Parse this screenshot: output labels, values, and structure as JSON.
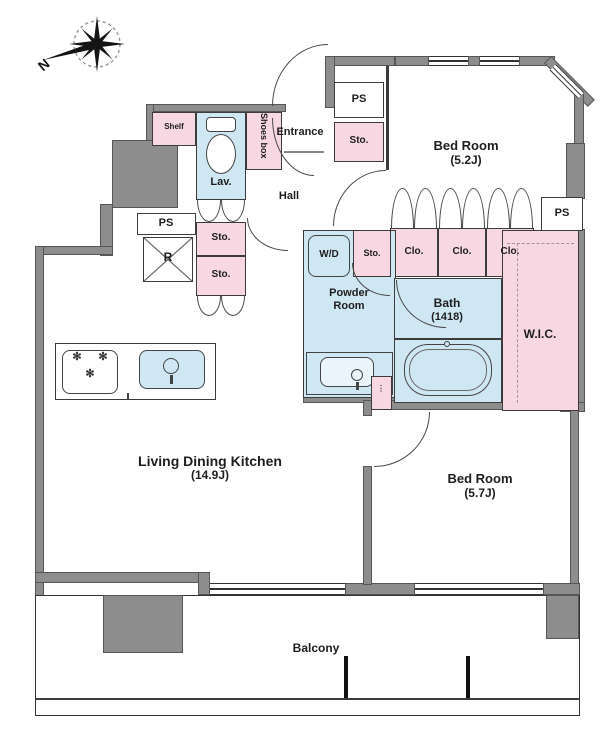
{
  "compass": {
    "north": "N"
  },
  "colors": {
    "wall": "#8d8d8d",
    "pink": "#f7d7e2",
    "blue": "#cfe7f3",
    "outline": "#3c3c3c"
  },
  "labels": {
    "shelf": "Shelf",
    "lavatory": "Lav.",
    "shoes_box": "Shoes box",
    "entrance": "Entrance",
    "hall": "Hall",
    "pipe_space": "PS",
    "storage": "Sto.",
    "refrigerator": "R",
    "washer_dryer": "W/D",
    "closet": "Clo.",
    "powder_room": "Powder Room",
    "bath_name": "Bath",
    "bath_size": "(1418)",
    "wic": "W.I.C.",
    "bedroom1_name": "Bed Room",
    "bedroom1_size": "(5.2J)",
    "bedroom2_name": "Bed Room",
    "bedroom2_size": "(5.7J)",
    "ldk_name": "Living Dining Kitchen",
    "ldk_size": "(14.9J)",
    "balcony": "Balcony"
  },
  "icons": {
    "burner_glyph": "✻",
    "mini_label_glyph": "⋮"
  }
}
